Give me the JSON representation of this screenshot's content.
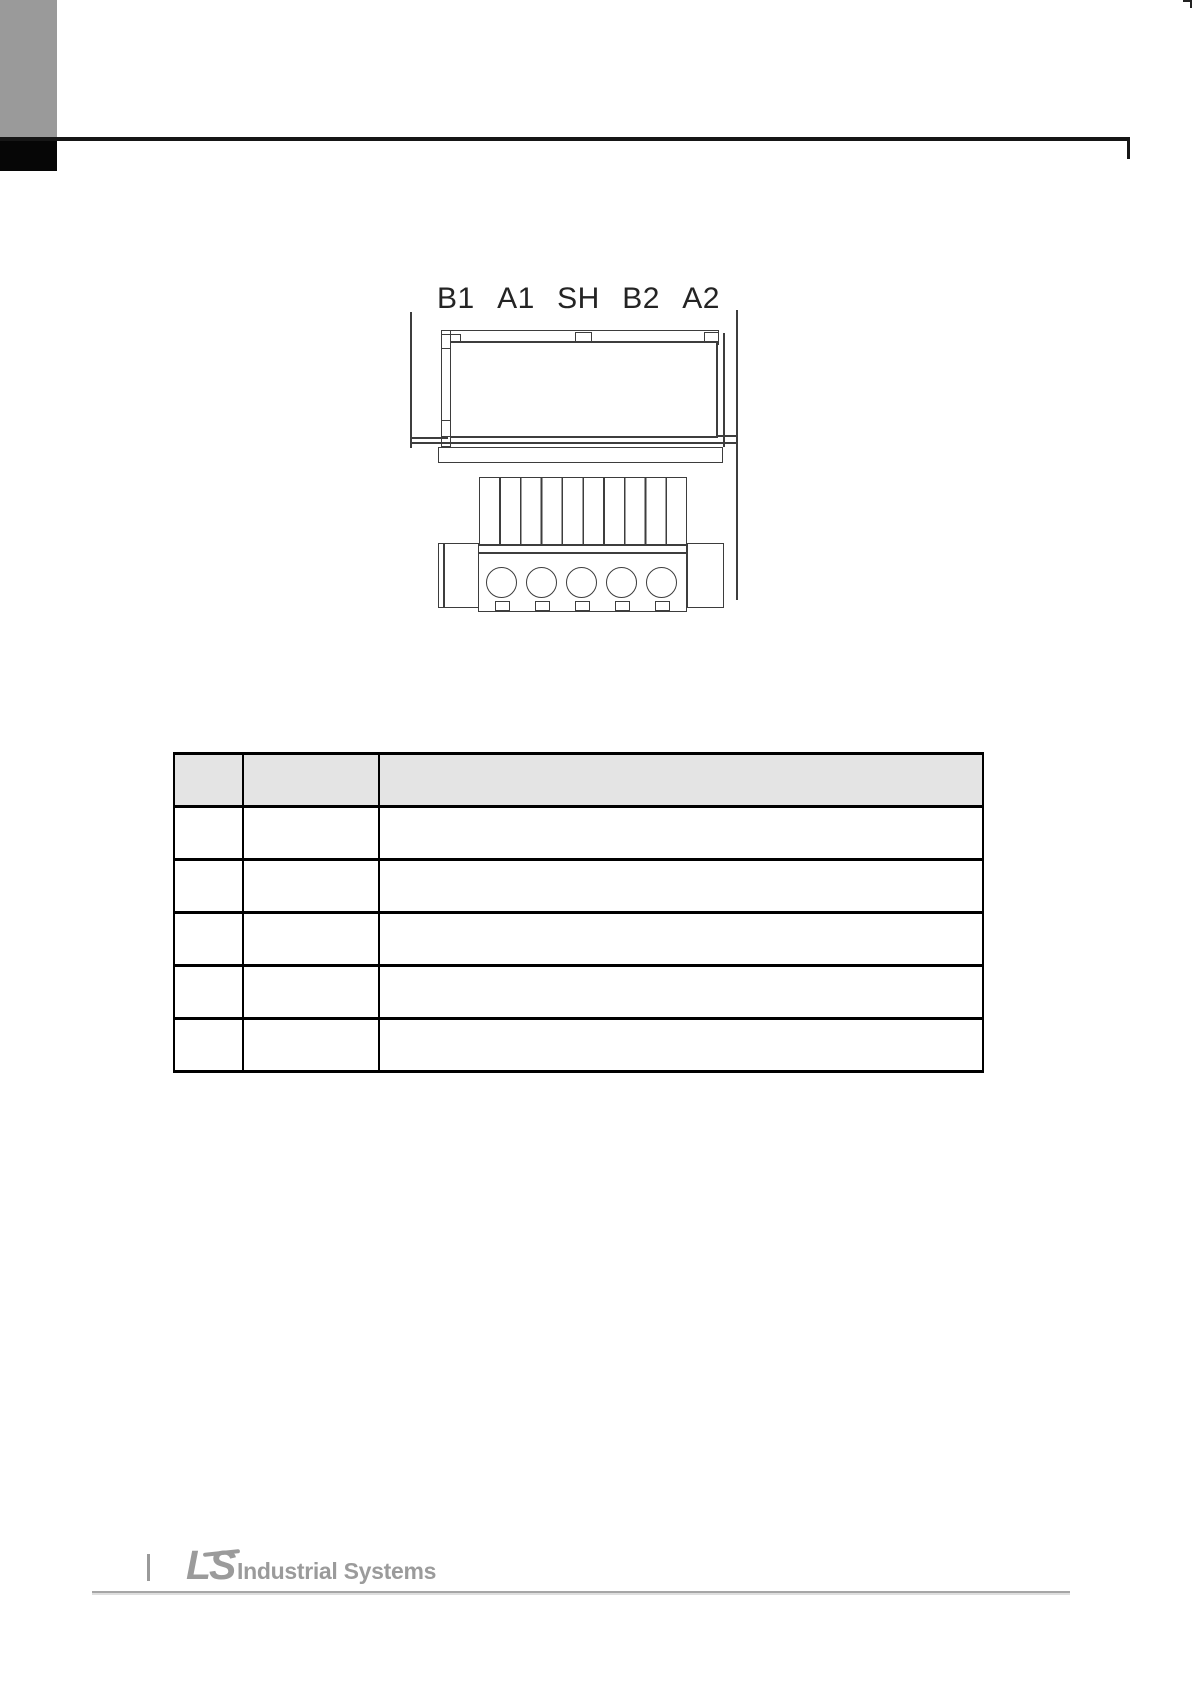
{
  "page": {
    "background": "#ffffff"
  },
  "header": {
    "tab_color": "#9a9a9a",
    "rule_color": "#161616"
  },
  "diagram": {
    "terminal_labels": [
      "B1",
      "A1",
      "SH",
      "B2",
      "A2"
    ],
    "line_color": "#3d3d3d"
  },
  "table": {
    "border_color": "#000000",
    "header_fill": "#e4e4e4",
    "header_cells": [
      "",
      "",
      ""
    ],
    "rows": [
      [
        "",
        "",
        ""
      ],
      [
        "",
        "",
        ""
      ],
      [
        "",
        "",
        ""
      ],
      [
        "",
        "",
        ""
      ],
      [
        "",
        "",
        ""
      ]
    ]
  },
  "footer": {
    "logo_ls": "LS",
    "logo_text": "Industrial Systems",
    "logo_color": "#9b9b9b",
    "rule_color": "#a6a6a6"
  }
}
